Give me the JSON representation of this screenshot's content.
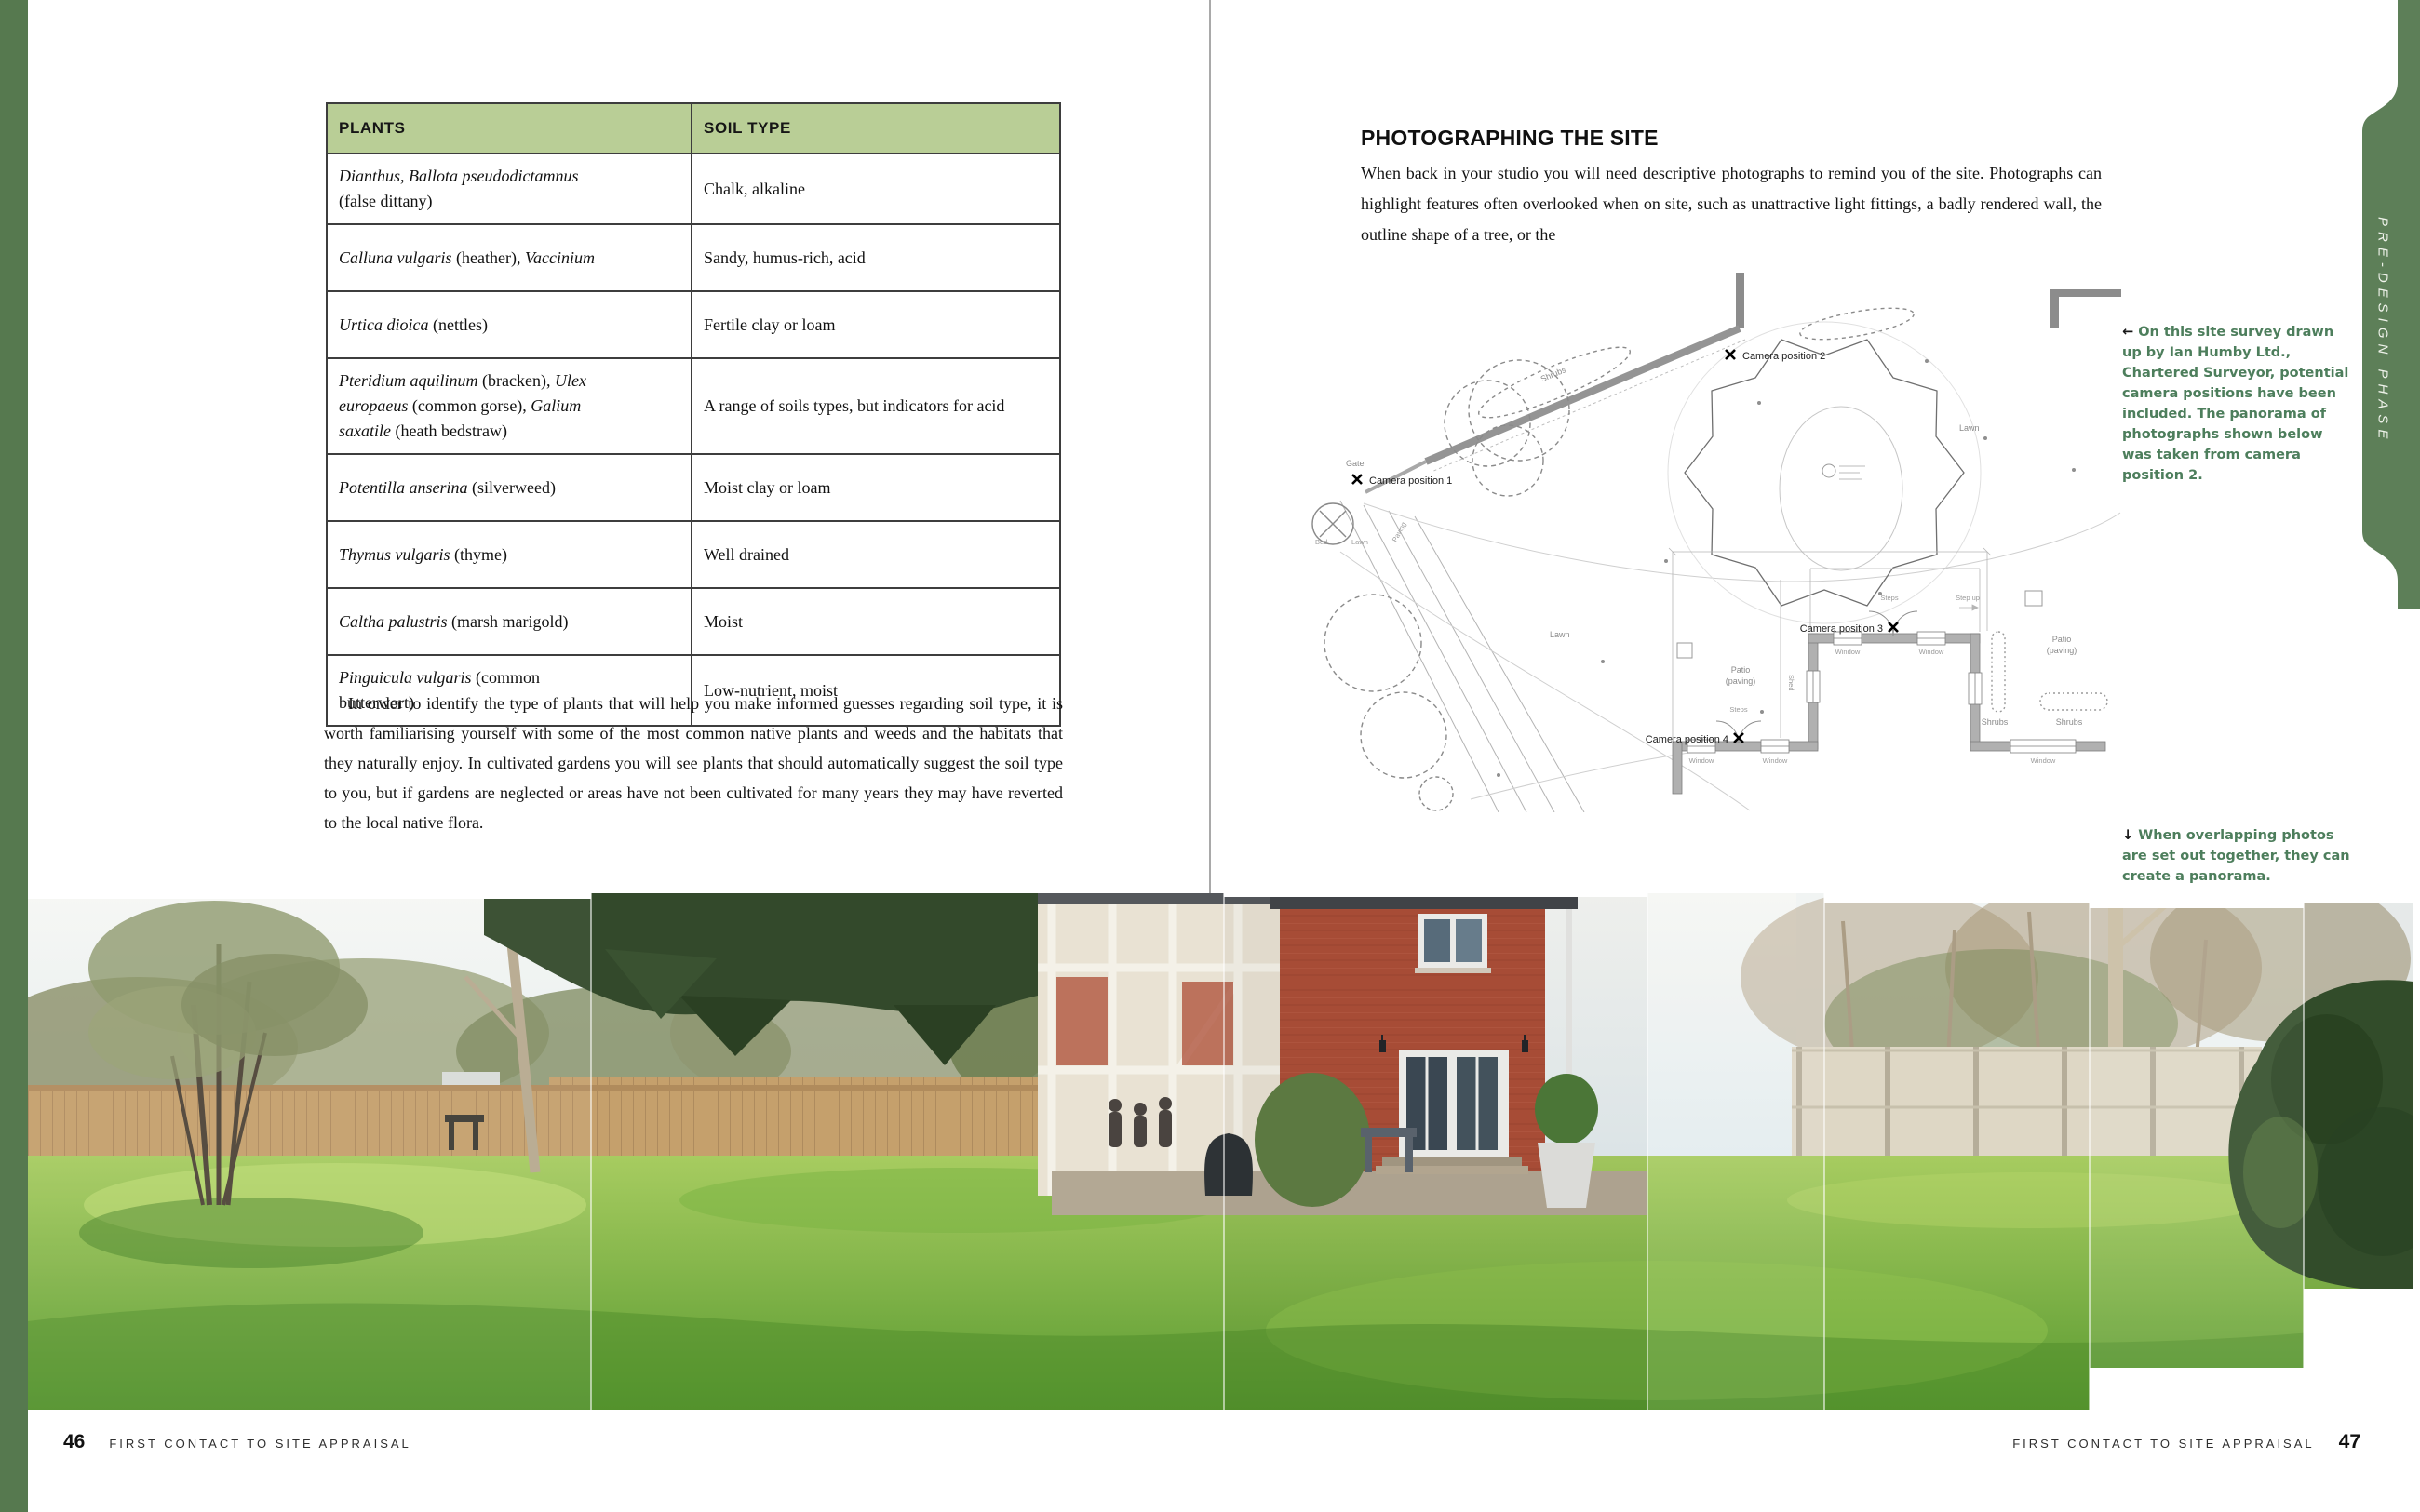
{
  "left_page": {
    "table": {
      "headers": [
        "PLANTS",
        "SOIL TYPE"
      ],
      "rows": [
        {
          "plant": [
            {
              "text": "Dianthus, Ballota pseudodictamnus",
              "italic": true
            },
            {
              "break": true
            },
            {
              "text": "(false dittany)",
              "italic": false
            }
          ],
          "soil": "Chalk, alkaline"
        },
        {
          "plant": [
            {
              "text": "Calluna vulgaris",
              "italic": true
            },
            {
              "text": " (heather), ",
              "italic": false
            },
            {
              "text": "Vaccinium",
              "italic": true
            }
          ],
          "soil": "Sandy, humus-rich, acid"
        },
        {
          "plant": [
            {
              "text": "Urtica dioica",
              "italic": true
            },
            {
              "text": " (nettles)",
              "italic": false
            }
          ],
          "soil": "Fertile clay or loam"
        },
        {
          "plant": [
            {
              "text": "Pteridium aquilinum",
              "italic": true
            },
            {
              "text": " (bracken), ",
              "italic": false
            },
            {
              "text": "Ulex",
              "italic": true
            },
            {
              "break": true
            },
            {
              "text": "europaeus",
              "italic": true
            },
            {
              "text": " (common gorse), ",
              "italic": false
            },
            {
              "text": "Galium",
              "italic": true
            },
            {
              "break": true
            },
            {
              "text": "saxatile",
              "italic": true
            },
            {
              "text": " (heath bedstraw)",
              "italic": false
            }
          ],
          "soil": "A range of soils types, but indicators for acid"
        },
        {
          "plant": [
            {
              "text": "Potentilla anserina",
              "italic": true
            },
            {
              "text": " (silverweed)",
              "italic": false
            }
          ],
          "soil": "Moist clay or loam"
        },
        {
          "plant": [
            {
              "text": "Thymus vulgaris",
              "italic": true
            },
            {
              "text": " (thyme)",
              "italic": false
            }
          ],
          "soil": "Well drained"
        },
        {
          "plant": [
            {
              "text": "Caltha palustris",
              "italic": true
            },
            {
              "text": " (marsh marigold)",
              "italic": false
            }
          ],
          "soil": "Moist"
        },
        {
          "plant": [
            {
              "text": "Pinguicula vulgaris",
              "italic": true
            },
            {
              "text": " (common",
              "italic": false
            },
            {
              "break": true
            },
            {
              "text": "butterwort)",
              "italic": false
            }
          ],
          "soil": "Low-nutrient, moist"
        }
      ]
    },
    "paragraph": "In order to identify the type of plants that will help you make informed guesses regarding soil type, it is worth familiarising yourself with some of the most common native plants and weeds and the habitats that they naturally enjoy. In cultivated gardens you will see plants that should automatically suggest the soil type to you, but if gardens are neglected or areas have not been cultivated for many years they may have reverted to the local native flora.",
    "footer": {
      "page_number": "46",
      "running_title": "FIRST CONTACT TO SITE APPRAISAL"
    }
  },
  "right_page": {
    "heading": "PHOTOGRAPHING THE SITE",
    "body": "When back in your studio you will need descriptive photographs to remind you of the site. Photographs can highlight features often overlooked when on site, such as unattractive light fittings, a badly rendered wall, the outline shape of a tree, or the",
    "captions": {
      "survey": {
        "arrow": "←",
        "text": " On this site survey drawn up by Ian Humby Ltd., Chartered Surveyor, potential camera positions have been included. The panorama of photographs shown below was taken from camera position 2."
      },
      "panorama": {
        "arrow": "↓",
        "text": " When overlapping photos are set out together, they can create a panorama."
      }
    },
    "side_tab": "PRE-DESIGN PHASE",
    "survey_labels": {
      "cam1": "Camera position 1",
      "cam2": "Camera position 2",
      "cam3": "Camera position 3",
      "cam4": "Camera position 4",
      "lawn": "Lawn",
      "patio_line1": "Patio",
      "patio_line2": "(paving)",
      "shrubs": "Shrubs",
      "window": "Window",
      "steps": "Steps",
      "step_up": "Step up",
      "gate": "Gate",
      "shed": "Shed",
      "bed": "Bed",
      "paving": "Paving"
    },
    "footer": {
      "running_title": "FIRST CONTACT TO SITE APPRAISAL",
      "page_number": "47"
    }
  },
  "colors": {
    "edge_strip_green": "#56794f",
    "tab_green": "#5d7f58",
    "table_header_green": "#b9ce96",
    "caption_green": "#4d7e5c"
  }
}
